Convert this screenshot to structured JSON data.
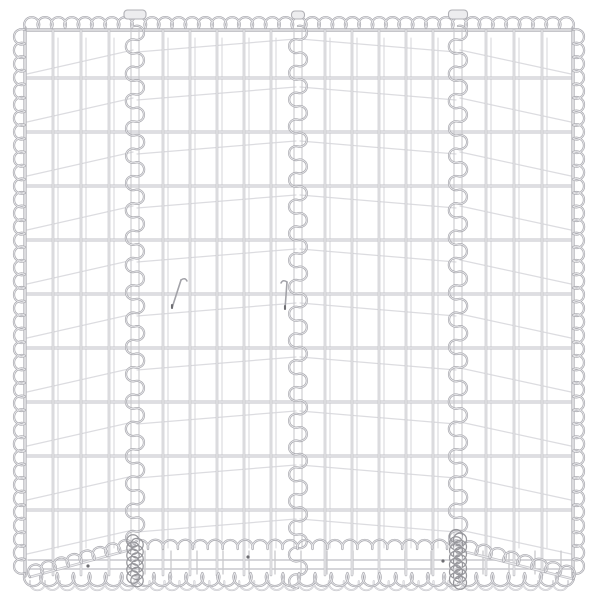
{
  "meta": {
    "description": "Product photo: trapezoid gabion basket raised-bed of silver galvanised steel wire mesh, four front panels joined by vertical spiral binders, spiral-wrapped edges, narrower base with slanted bottom corner spirals, on a plain white background"
  },
  "canvas": {
    "width": 600,
    "height": 600,
    "background": "#ffffff"
  },
  "colors": {
    "bg": "#ffffff",
    "wire_edge": "#c2c2c7",
    "wire_core": "#efeff1",
    "selvedge_edge": "#b4b4b9",
    "selvedge_core": "#ececee",
    "ghost": "#dcdce0",
    "ghost_v": "#d8d8dc",
    "strip": "#c9c9cd",
    "spiral_edge": "#a6a6ac",
    "spiral_core": "#e8e8eb",
    "spiral_light": "#c3c3c8",
    "tangle": "#97979c",
    "detail": "#a2a2a8",
    "tab_fill": "#ededef",
    "tab_stroke": "#b0b0b5",
    "dot": "#6e6e73"
  },
  "mesh": {
    "left": 25,
    "right": 573,
    "top": 30,
    "front_bottom": 548,
    "bottom": 576,
    "h_rows": [
      30,
      78,
      132,
      186,
      240,
      294,
      348,
      402,
      456,
      510
    ],
    "panel_bounds": [
      25,
      135,
      298,
      458,
      573
    ],
    "v_wires": [
      53,
      81,
      109,
      163,
      190,
      217,
      244,
      271,
      325,
      352,
      379,
      406,
      433,
      486,
      514,
      542
    ],
    "ghost_h_offsets": [
      [
        44,
        20
      ],
      [
        22,
        9
      ],
      [
        9,
        22
      ],
      [
        20,
        44
      ]
    ],
    "ghost_v_dx": 5,
    "strip_rows": [
      560,
      569
    ],
    "strip_v_start": 145,
    "strip_v_end": 562,
    "strip_v_step": 26,
    "strip_v_y1": 551,
    "strip_v_y2": 574
  },
  "spirals": {
    "loop": 13.5,
    "rf_edge": 0.56,
    "rf_helix": 0.52,
    "rf_base": 0.51,
    "rf_bottom": 0.56,
    "inner_x": [
      135,
      298,
      458
    ],
    "inner_y1": 26,
    "inner_y2_side": 545,
    "inner_y2_mid": 588,
    "top_y": 28,
    "bottom_y": 573,
    "bottom2_y": 581,
    "bottom_loop": 16,
    "base_row": {
      "x1": 133,
      "y1": 549,
      "x2": 462,
      "y2": 549,
      "loop": 15
    },
    "slants": [
      {
        "x1": 30,
        "y1": 577,
        "x2": 133,
        "y2": 549
      },
      {
        "x1": 462,
        "y1": 551,
        "x2": 573,
        "y2": 579
      }
    ],
    "slant_loop": 14
  },
  "details": {
    "tangles": [
      {
        "x": 135,
        "y1": 541,
        "y2": 583,
        "r": 6.2
      },
      {
        "x": 458,
        "y1": 536,
        "y2": 585,
        "r": 6.5
      }
    ],
    "tabs": [
      {
        "x": 135,
        "w": 22,
        "y": 10,
        "h": 9
      },
      {
        "x": 298,
        "w": 13,
        "y": 11,
        "h": 8
      },
      {
        "x": 458,
        "w": 19,
        "y": 10,
        "h": 9
      }
    ],
    "ties": [
      {
        "x1": 181,
        "y1": 280,
        "x2": 172,
        "y2": 308,
        "hook": 1
      },
      {
        "x1": 287,
        "y1": 282,
        "x2": 285,
        "y2": 309,
        "hook": -1
      }
    ],
    "dots": [
      [
        88,
        566
      ],
      [
        248,
        557
      ],
      [
        443,
        561
      ]
    ]
  }
}
